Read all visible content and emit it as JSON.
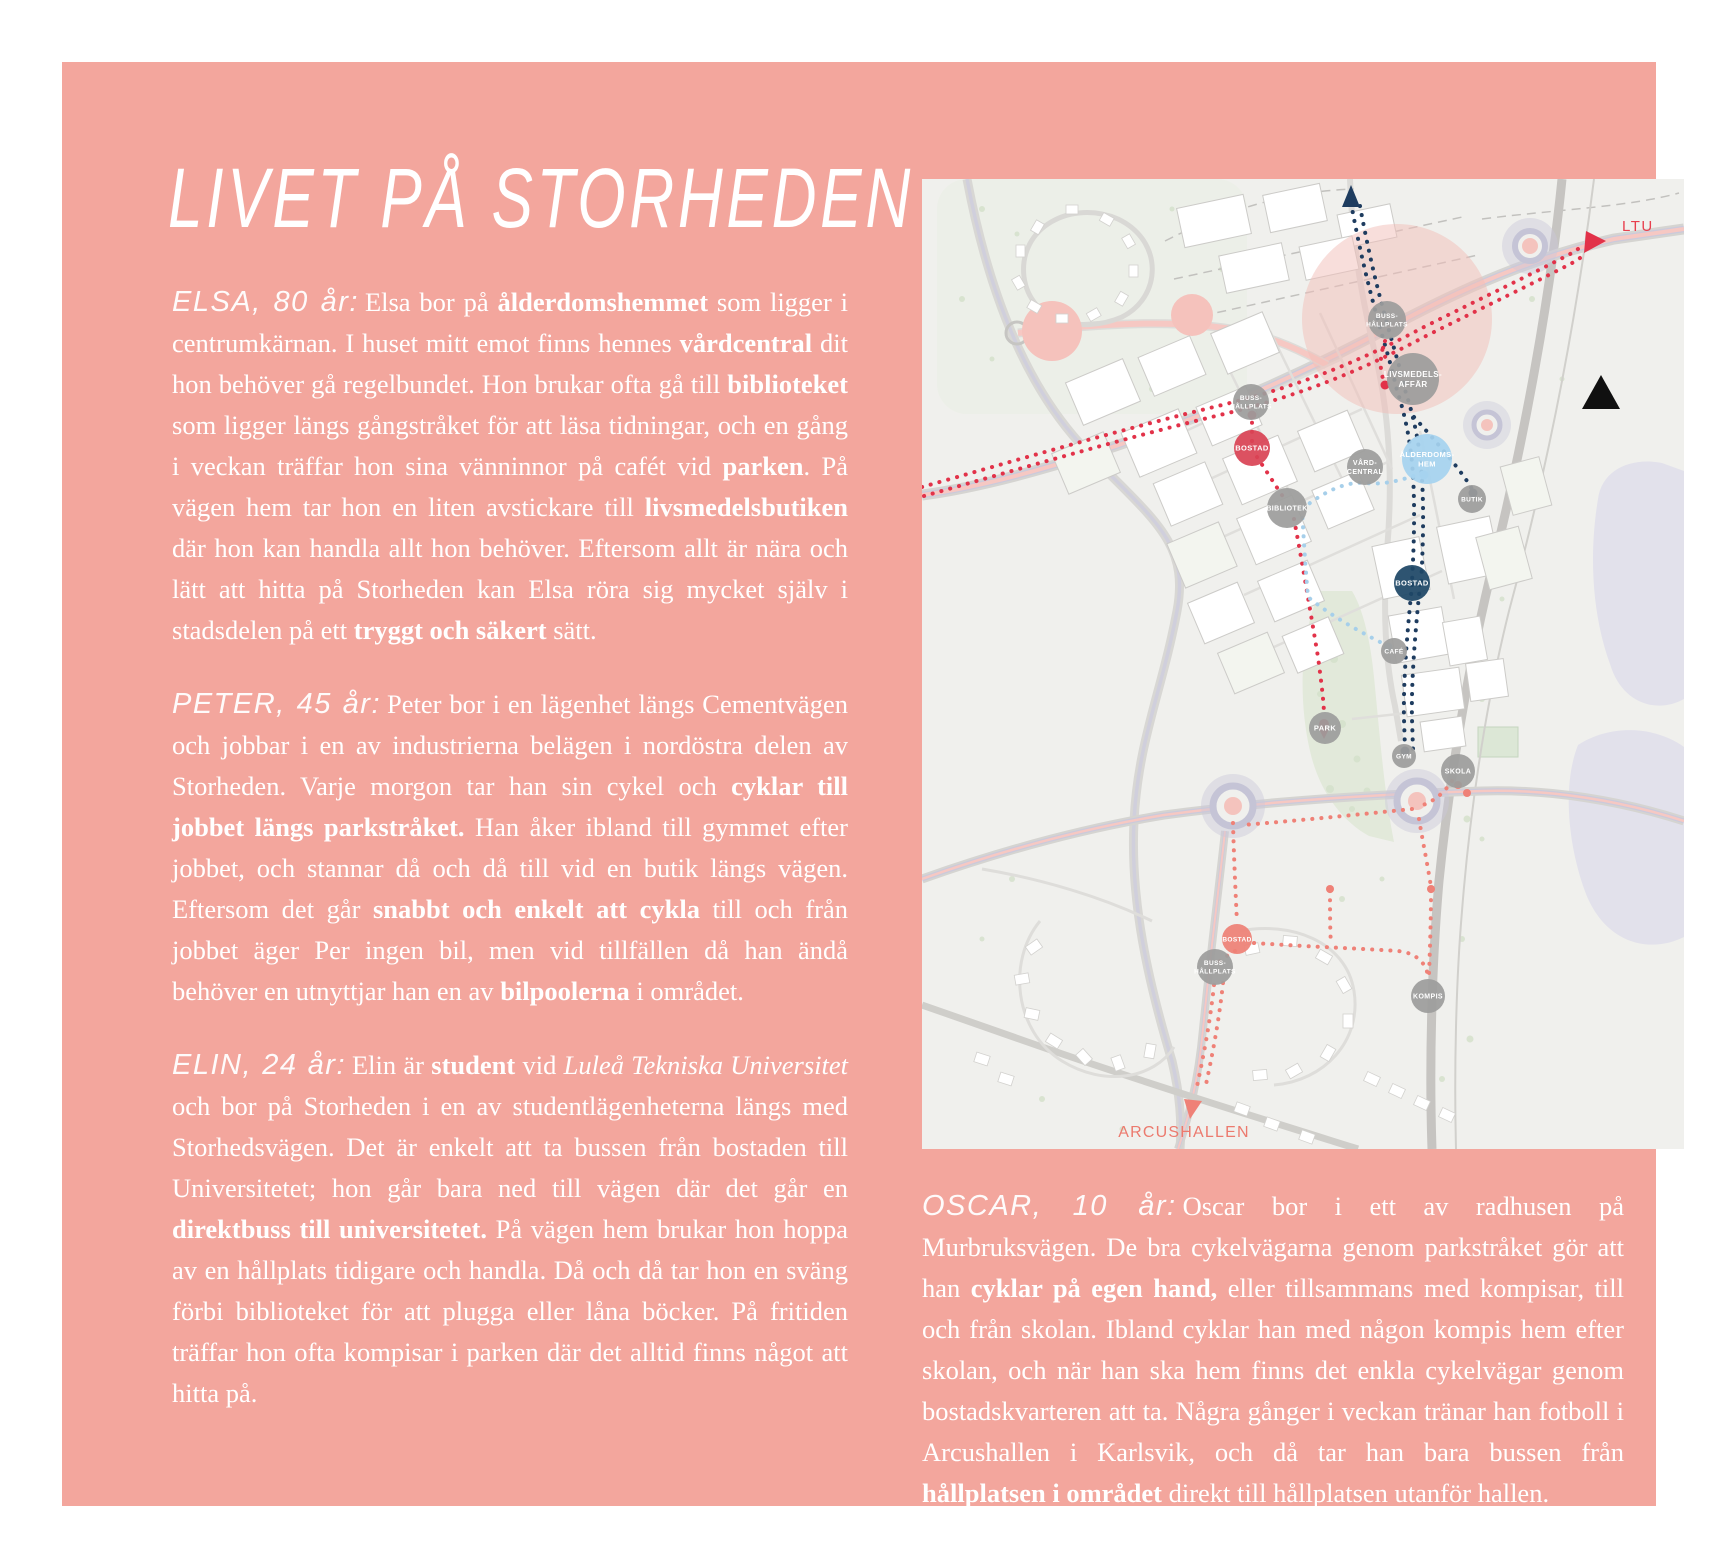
{
  "page": {
    "title": "LIVET PÅ STORHEDEN",
    "background_color": "#F3A69D",
    "text_color": "#FFFFFF"
  },
  "paragraphs": [
    {
      "name": "ELSA, 80 år:",
      "segments": [
        {
          "t": "Elsa bor på "
        },
        {
          "t": "ålderdomshemmet",
          "b": true
        },
        {
          "t": " som ligger i centrumkärnan. I huset mitt emot finns hennes "
        },
        {
          "t": "vårdcentral",
          "b": true
        },
        {
          "t": " dit hon behöver gå regelbundet. Hon brukar ofta gå till "
        },
        {
          "t": "biblioteket",
          "b": true
        },
        {
          "t": " som ligger längs gångstråket för att läsa tidningar, och en gång i veckan träffar hon sina vänninnor på cafét vid "
        },
        {
          "t": "parken",
          "b": true
        },
        {
          "t": ". På vägen hem tar hon en liten avstickare till "
        },
        {
          "t": "livsmedelsbutiken",
          "b": true
        },
        {
          "t": " där hon kan handla allt hon behöver. Eftersom allt är nära och lätt att hitta på Storheden kan Elsa röra sig mycket själv i stadsdelen på ett "
        },
        {
          "t": "tryggt och säkert",
          "b": true
        },
        {
          "t": " sätt."
        }
      ]
    },
    {
      "name": "PETER, 45 år:",
      "segments": [
        {
          "t": "Peter bor i en lägenhet längs Cementvägen och jobbar i en av industrierna belägen i nordöstra delen av Storheden. Varje morgon tar han sin cykel och "
        },
        {
          "t": "cyklar till jobbet längs parkstråket.",
          "b": true
        },
        {
          "t": " Han åker ibland till gymmet efter jobbet, och stannar då och då till vid en butik längs vägen. Eftersom det går "
        },
        {
          "t": "snabbt och enkelt att cykla",
          "b": true
        },
        {
          "t": " till och från jobbet äger Per ingen bil, men vid tillfällen då han ändå behöver en utnyttjar han en av "
        },
        {
          "t": "bilpoolerna",
          "b": true
        },
        {
          "t": " i området."
        }
      ]
    },
    {
      "name": "ELIN, 24 år:",
      "segments": [
        {
          "t": "Elin är "
        },
        {
          "t": "student",
          "b": true
        },
        {
          "t": " vid "
        },
        {
          "t": "Luleå Tekniska Universitet",
          "i": true
        },
        {
          "t": " och bor på Storheden i en av studentlägenheterna längs med Storhedsvägen. Det är enkelt att ta bussen från bostaden till Universitetet; hon går bara ned till vägen där det går en "
        },
        {
          "t": "direktbuss till universitetet.",
          "b": true
        },
        {
          "t": " På vägen hem brukar hon hoppa av en hållplats tidigare och handla. Då och då tar hon en sväng förbi biblioteket för att plugga eller låna böcker. På fritiden träffar hon ofta kompisar i parken där det alltid finns något att hitta på."
        }
      ]
    },
    {
      "name": "OSCAR, 10 år:",
      "segments": [
        {
          "t": "Oscar bor i ett av radhusen på Murbruksvägen. De bra cykelvägarna genom parkstråket gör att han "
        },
        {
          "t": "cyklar på egen hand,",
          "b": true
        },
        {
          "t": " eller tillsammans med kompisar, till och från skolan. Ibland cyklar han med någon kompis hem efter skolan, och när han ska hem finns det enkla cykelvägar genom bostadskvarteren att ta. Några gånger i veckan tränar han fotboll i Arcushallen i Karlsvik, och då tar han bara bussen från "
        },
        {
          "t": "hållplatsen i området",
          "b": true
        },
        {
          "t": " direkt till hållplatsen utanför hallen."
        }
      ]
    }
  ],
  "map": {
    "colors": {
      "background": "#F0F0ED",
      "node_gray": "#9D9D9C",
      "node_red": "#D94455",
      "node_navy": "#1E4766",
      "node_blue": "#A6D3EF",
      "node_salmon": "#EE8176",
      "route_navy": "#1E3C5F",
      "route_red": "#E23249",
      "route_blue": "#A6CFEA",
      "route_salmon": "#EF8177",
      "road_pink": "#F6C8C3",
      "road_lavender": "#CBCADB",
      "highlight_pink": "#F2BDB7"
    },
    "nodes": [
      {
        "label": "BUSS-\nHÅLLPLATS",
        "x": 465,
        "y": 141,
        "r": 19,
        "color": "gray",
        "fs": 6.5
      },
      {
        "label": "LIVSMEDELS-\nAFFÄR",
        "x": 491,
        "y": 200,
        "r": 26,
        "color": "gray",
        "fs": 8
      },
      {
        "label": "BUSS-\nHÅLLPLATS",
        "x": 329,
        "y": 223,
        "r": 18,
        "color": "gray",
        "fs": 6.5
      },
      {
        "label": "BOSTAD",
        "x": 330,
        "y": 269,
        "r": 18,
        "color": "red",
        "fs": 7.5
      },
      {
        "label": "VÅRD-\nCENTRAL",
        "x": 443,
        "y": 288,
        "r": 18,
        "color": "gray",
        "fs": 7
      },
      {
        "label": "ÅLDERDOMS-\nHEM",
        "x": 505,
        "y": 280,
        "r": 25,
        "color": "blue",
        "fs": 7.5
      },
      {
        "label": "BIBLIOTEK",
        "x": 365,
        "y": 329,
        "r": 20,
        "color": "gray",
        "fs": 7
      },
      {
        "label": "BUTIK",
        "x": 550,
        "y": 320,
        "r": 14,
        "color": "gray",
        "fs": 6.5
      },
      {
        "label": "BOSTAD",
        "x": 490,
        "y": 404,
        "r": 18,
        "color": "navy",
        "fs": 7.5
      },
      {
        "label": "CAFÉ",
        "x": 472,
        "y": 472,
        "r": 13,
        "color": "gray",
        "fs": 6.5
      },
      {
        "label": "PARK",
        "x": 403,
        "y": 549,
        "r": 16,
        "color": "gray",
        "fs": 7.5
      },
      {
        "label": "GYM",
        "x": 482,
        "y": 577,
        "r": 12,
        "color": "gray",
        "fs": 6.5
      },
      {
        "label": "SKOLA",
        "x": 536,
        "y": 592,
        "r": 17,
        "color": "gray",
        "fs": 7
      },
      {
        "label": "BOSTAD",
        "x": 315,
        "y": 760,
        "r": 15,
        "color": "salmon",
        "fs": 6.5
      },
      {
        "label": "BUSS-\nHÅLLPLATS",
        "x": 293,
        "y": 788,
        "r": 18,
        "color": "gray",
        "fs": 6.5
      },
      {
        "label": "KOMPIS",
        "x": 506,
        "y": 817,
        "r": 17,
        "color": "gray",
        "fs": 7
      }
    ],
    "labels": {
      "ltu": "LTU",
      "arcushallen": "ARCUSHALLEN"
    }
  }
}
